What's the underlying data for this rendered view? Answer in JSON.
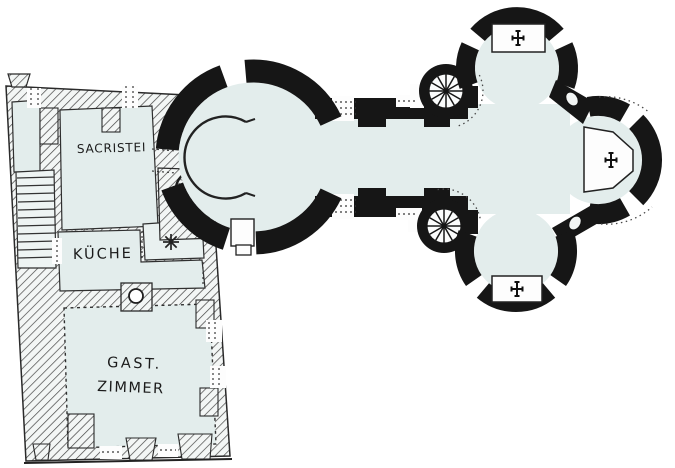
{
  "plan": {
    "rooms": [
      {
        "name": "sacristy",
        "label": "SACRISTEI"
      },
      {
        "name": "kitchen",
        "label": "KÜCHE"
      },
      {
        "name": "guest-room",
        "label_line1": "GAST.",
        "label_line2": "ZIMMER"
      }
    ],
    "symbols": [
      {
        "name": "altar-cross-icon",
        "glyph": "✚",
        "count": 3
      },
      {
        "name": "hearth-star-icon",
        "glyph": "✳",
        "count": 1
      },
      {
        "name": "spiral-stair-icon",
        "count": 2
      },
      {
        "name": "staircase-icon",
        "count": 1
      }
    ],
    "colors": {
      "paper": "#ffffff",
      "floor": "#e3edec",
      "wall": "#161616",
      "hatch": "#454545",
      "line": "#262626"
    }
  }
}
